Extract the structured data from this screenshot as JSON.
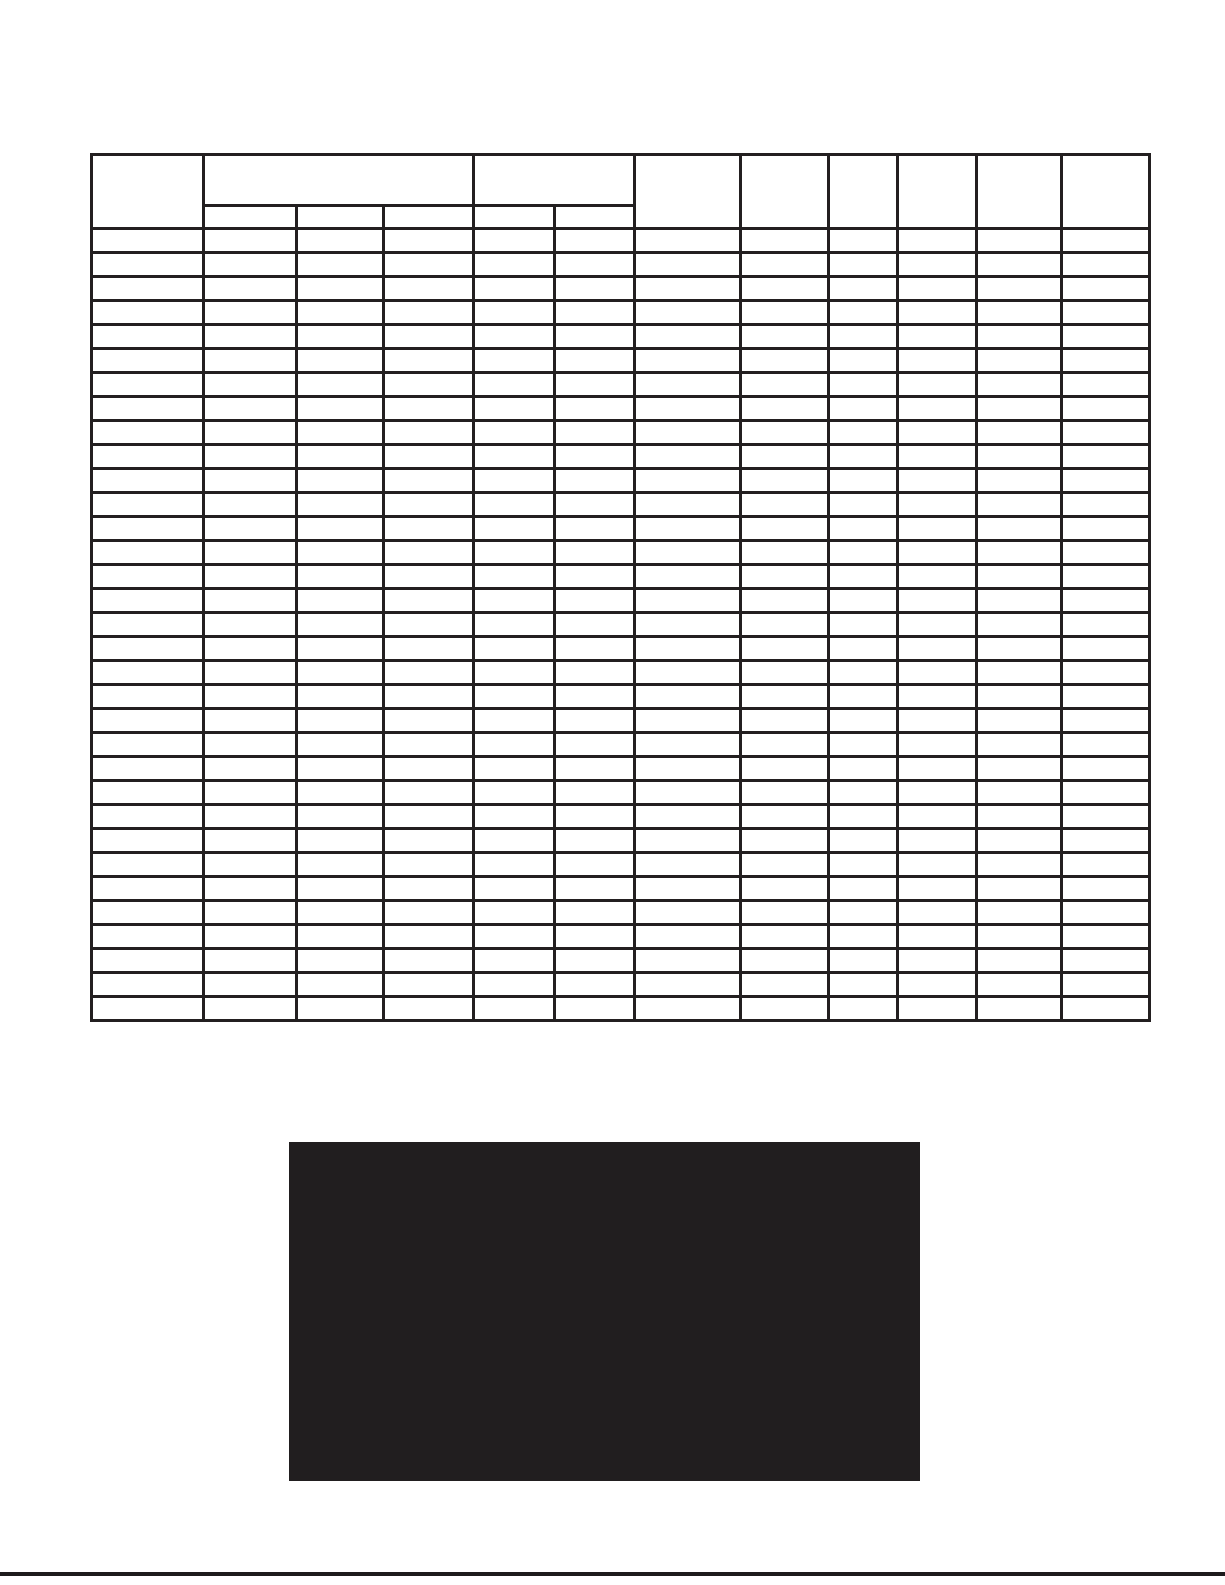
{
  "page": {
    "background_color": "#ffffff"
  },
  "grid_table": {
    "border_color": "#231f20",
    "column_count": 12,
    "body_row_count": 33,
    "header": {
      "corner_cell_text": "",
      "group_cells": [
        {
          "text": "",
          "colspan": 3,
          "sub_cells": [
            "",
            "",
            ""
          ]
        },
        {
          "text": "",
          "colspan": 2,
          "sub_cells": [
            "",
            ""
          ]
        }
      ],
      "tall_cells": [
        "",
        "",
        "",
        "",
        "",
        ""
      ]
    },
    "body_cell_text": ""
  },
  "redaction_block": {
    "color": "#211e1f"
  },
  "footer_rule": {
    "color": "#1d1b1c"
  }
}
